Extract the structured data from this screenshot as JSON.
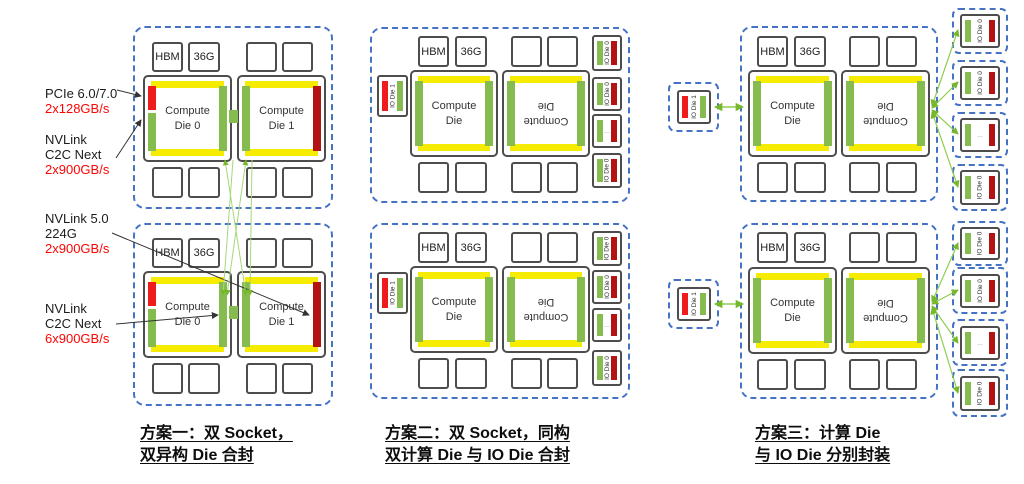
{
  "colors": {
    "package_dashed_border": "#4472c4",
    "die_border": "#4d4d4d",
    "hbm_io_bar_yellow": "#f6ec00",
    "c2c_link_bar_green": "#85bb4f",
    "pcie_bar_red": "#ee1c1c",
    "nvlink_bar_dark_red": "#b31312",
    "link_line_green": "#8fce4e",
    "bandwidth_text_red": "#fb0503"
  },
  "memory": {
    "hbm": "HBM",
    "capacity": "36G"
  },
  "dies": {
    "compute0": "Compute\nDie 0",
    "compute1": "Compute\nDie 1",
    "compute": "Compute\nDie",
    "io_die0": "IO Die 0",
    "io_die1": "IO Die 1",
    "ellipsis": "..."
  },
  "interconnects": {
    "pcie": {
      "name": "PCIe 6.0/7.0",
      "bandwidth": "2x128GB/s"
    },
    "c2c_top": {
      "name": "NVLink\nC2C Next",
      "bandwidth": "2x900GB/s"
    },
    "nvlink5": {
      "name": "NVLink 5.0\n224G",
      "bandwidth": "2x900GB/s"
    },
    "c2c_bottom": {
      "name": "NVLink\nC2C Next",
      "bandwidth": "6x900GB/s"
    }
  },
  "captions": {
    "scheme1": {
      "line1": "方案一：双 Socket，",
      "line2": "双异构 Die 合封"
    },
    "scheme2": {
      "line1": "方案二：双 Socket，同构",
      "line2": "双计算 Die 与 IO Die 合封"
    },
    "scheme3": {
      "line1": "方案三：计算 Die",
      "line2": "与 IO Die 分别封装"
    }
  }
}
